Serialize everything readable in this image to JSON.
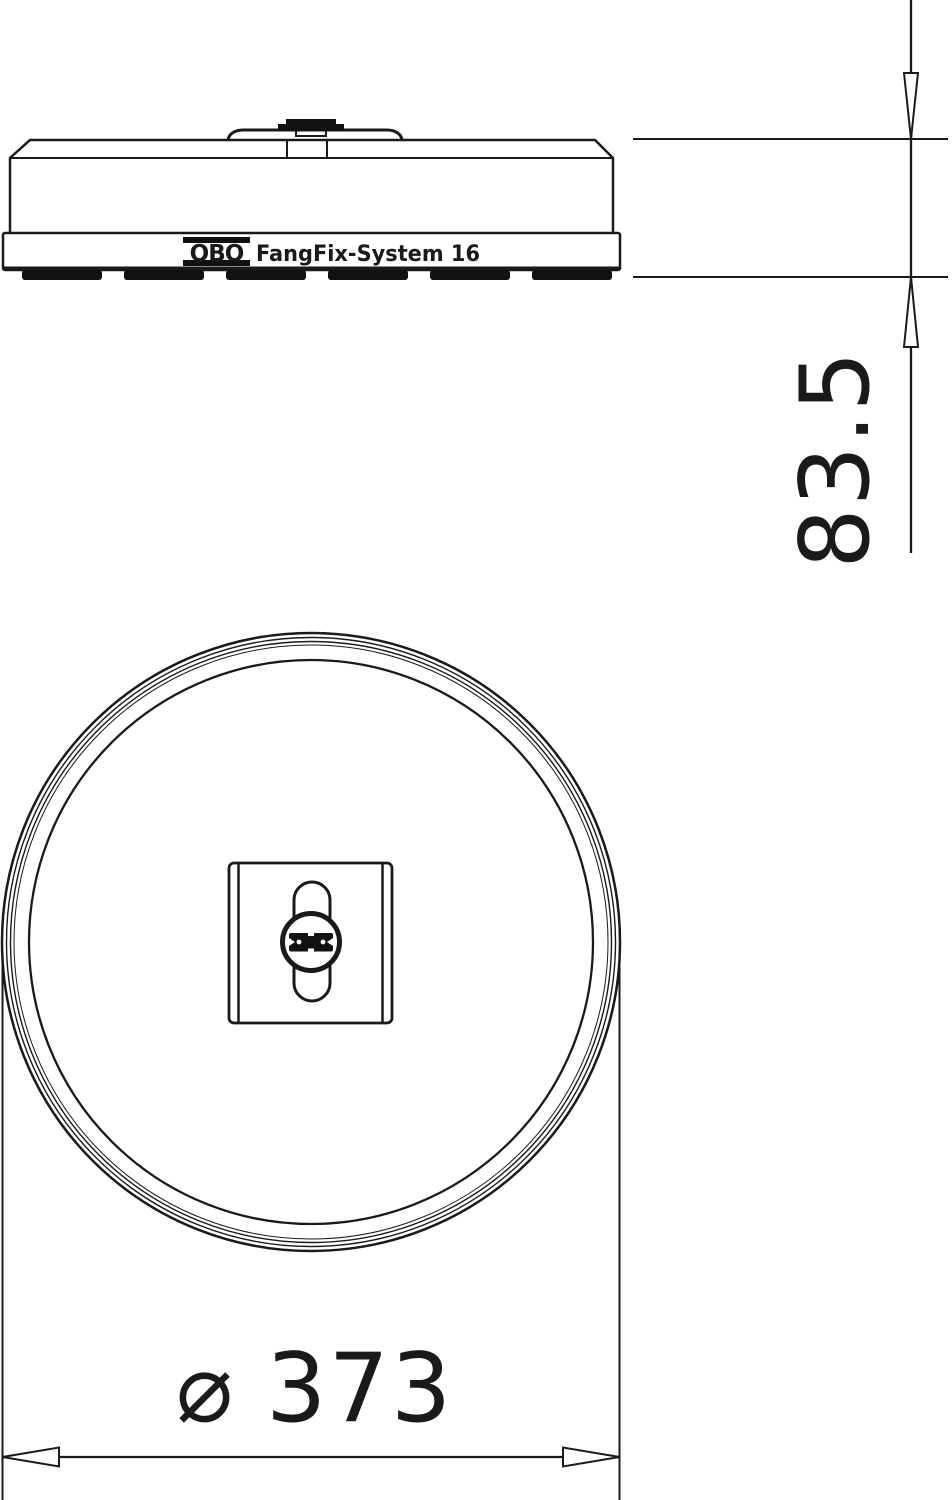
{
  "side_view": {
    "label": {
      "brand": "OBO",
      "product": "FangFix-System 16"
    }
  },
  "dimensions": {
    "height": {
      "value": "83.5"
    },
    "diameter": {
      "symbol": "⌀",
      "value": "373"
    }
  },
  "colors": {
    "line": "#1a1a1a",
    "ink": "#111111",
    "background": "#ffffff"
  }
}
